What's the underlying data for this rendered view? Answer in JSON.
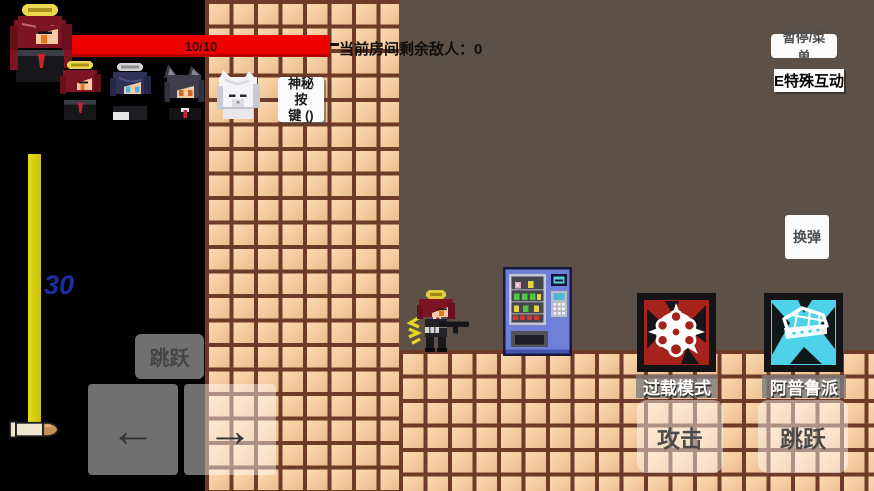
{
  "hud": {
    "health": {
      "value": "10/10"
    },
    "enemy_counter": "当前房间剩余敌人：0",
    "ammo": {
      "count": "30"
    },
    "party": {
      "main_icon": "red-hair-halo-portrait",
      "member_icons": [
        "red-hair-halo-portrait-small",
        "navy-hair-gray-halo-portrait",
        "wolf-ears-portrait",
        "white-fluffy-portrait"
      ]
    }
  },
  "top_right": {
    "pause_label": "暂停/菜单",
    "interact_label": "E特殊互动"
  },
  "mystery_button": {
    "line1": "神秘按",
    "line2": "键 ()"
  },
  "reload_label": "换弹",
  "skills": [
    {
      "icon": "overload-cluster-icon",
      "label": "过载模式",
      "color": "#a6221d"
    },
    {
      "icon": "apple-pie-icon",
      "label": "阿普鲁派",
      "color": "#4ed2ea"
    }
  ],
  "controls": {
    "jump_small": "跳跃",
    "arrow_left": "←",
    "arrow_right": "→",
    "attack": "攻击",
    "jump_right": "跳跃"
  },
  "colors": {
    "health_red": "#ef0000",
    "ammo_yellow": "#d9cf12",
    "ammo_count_blue": "#1b2f9e",
    "scene_bg": "#5d5147",
    "tile": "#f5cda1",
    "grout": "#6e3b28",
    "hud_black": "#000000"
  }
}
